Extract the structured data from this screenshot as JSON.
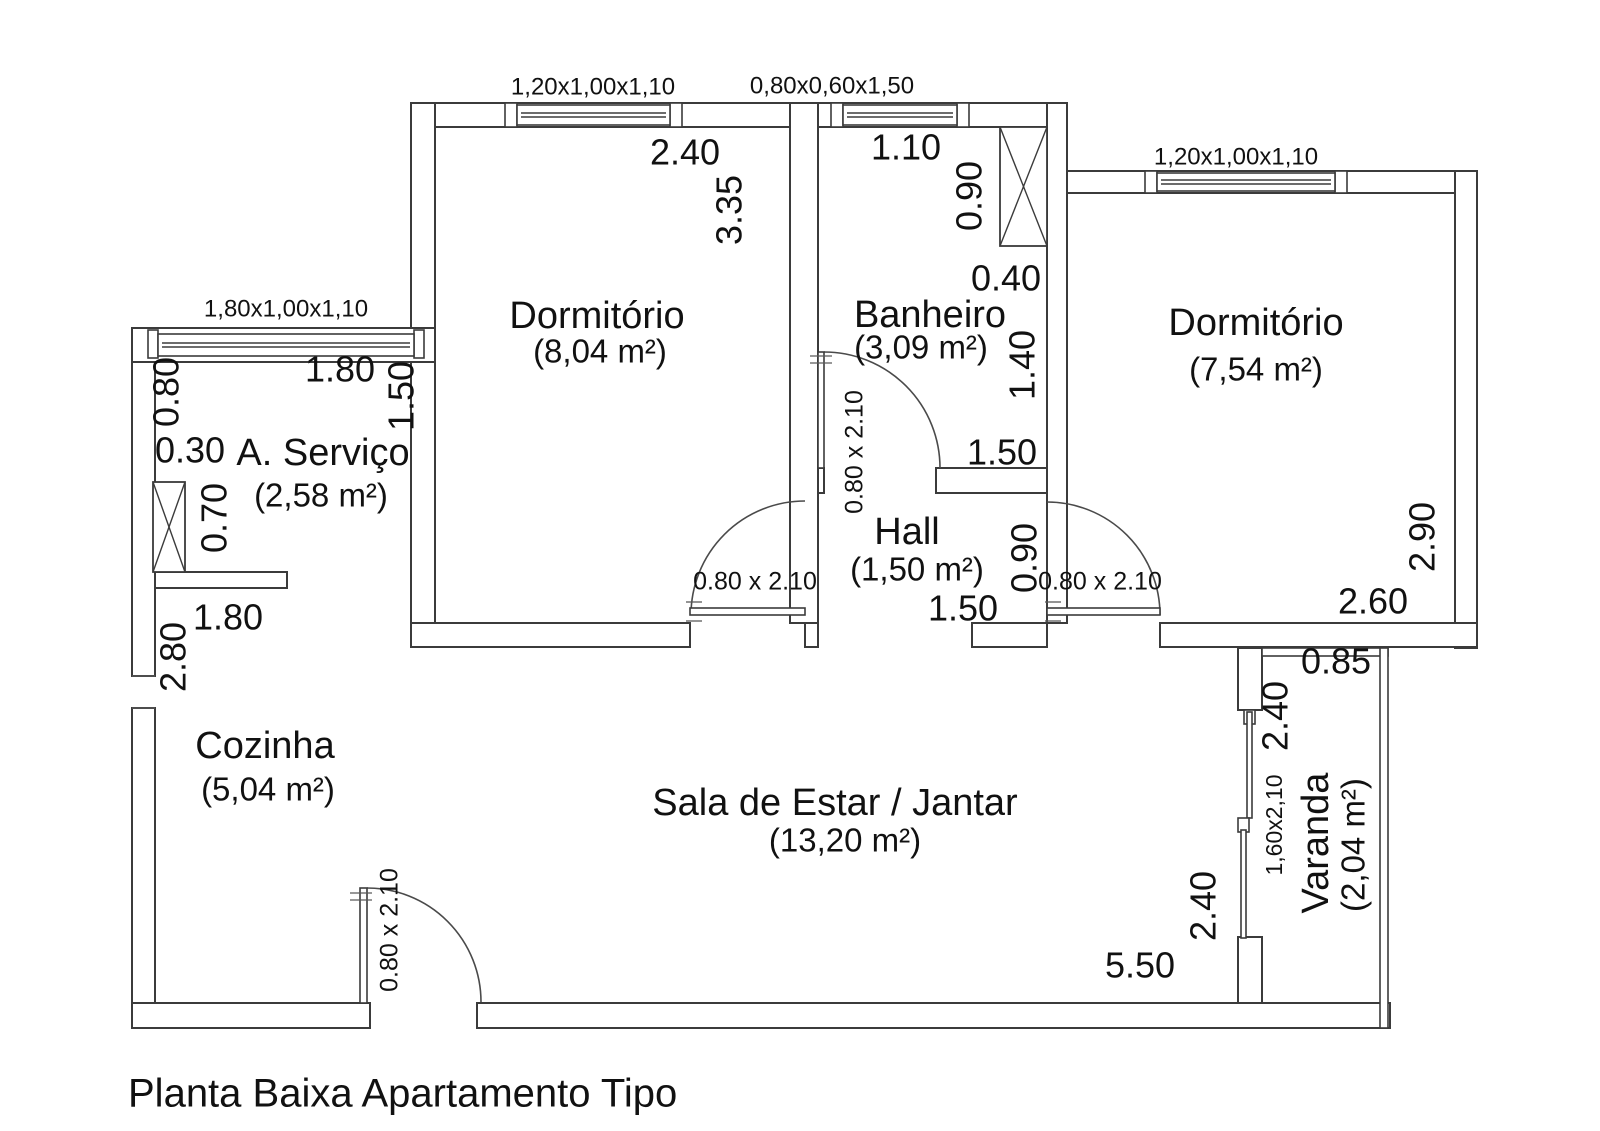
{
  "title": "Planta Baixa Apartamento Tipo",
  "rooms": {
    "dorm1": {
      "name": "Dormitório",
      "area": "(8,04 m²)"
    },
    "banheiro": {
      "name": "Banheiro",
      "area": "(3,09 m²)"
    },
    "dorm2": {
      "name": "Dormitório",
      "area": "(7,54 m²)"
    },
    "servico": {
      "name": "A. Serviço",
      "area": "(2,58 m²)"
    },
    "hall": {
      "name": "Hall",
      "area": "(1,50 m²)"
    },
    "cozinha": {
      "name": "Cozinha",
      "area": "(5,04 m²)"
    },
    "sala": {
      "name": "Sala de Estar / Jantar",
      "area": "(13,20 m²)"
    },
    "varanda": {
      "name": "Varanda",
      "area": "(2,04 m²)"
    }
  },
  "window_labels": {
    "dorm1": "1,20x1,00x1,10",
    "banheiro": "0,80x0,60x1,50",
    "dorm2": "1,20x1,00x1,10",
    "servico": "1,80x1,00x1,10"
  },
  "door_label": "0.80 x 2.10",
  "sliding_door_label": "1,60x2,10",
  "dimensions": {
    "dorm1_width": "2.40",
    "dorm1_height": "3.35",
    "banheiro_top_width": "1.10",
    "shaft_height": "0.90",
    "shaft_width": "0.40",
    "banheiro_lower_height": "1.40",
    "banheiro_width": "1.50",
    "servico_left_height": "0.80",
    "servico_width": "1.80",
    "servico_right_height": "1.50",
    "servico_offset": "0.30",
    "servico_shaft_height": "0.70",
    "cozinha_width": "1.80",
    "cozinha_height": "2.80",
    "hall_width": "1.50",
    "hall_height": "0.90",
    "dorm2_height": "2.90",
    "dorm2_width": "2.60",
    "varanda_width": "0.85",
    "varanda_height": "2.40",
    "sala_height": "2.40",
    "sala_width": "5.50"
  },
  "colors": {
    "line": "#3b3b3b",
    "text": "#111111",
    "background": "#ffffff"
  }
}
